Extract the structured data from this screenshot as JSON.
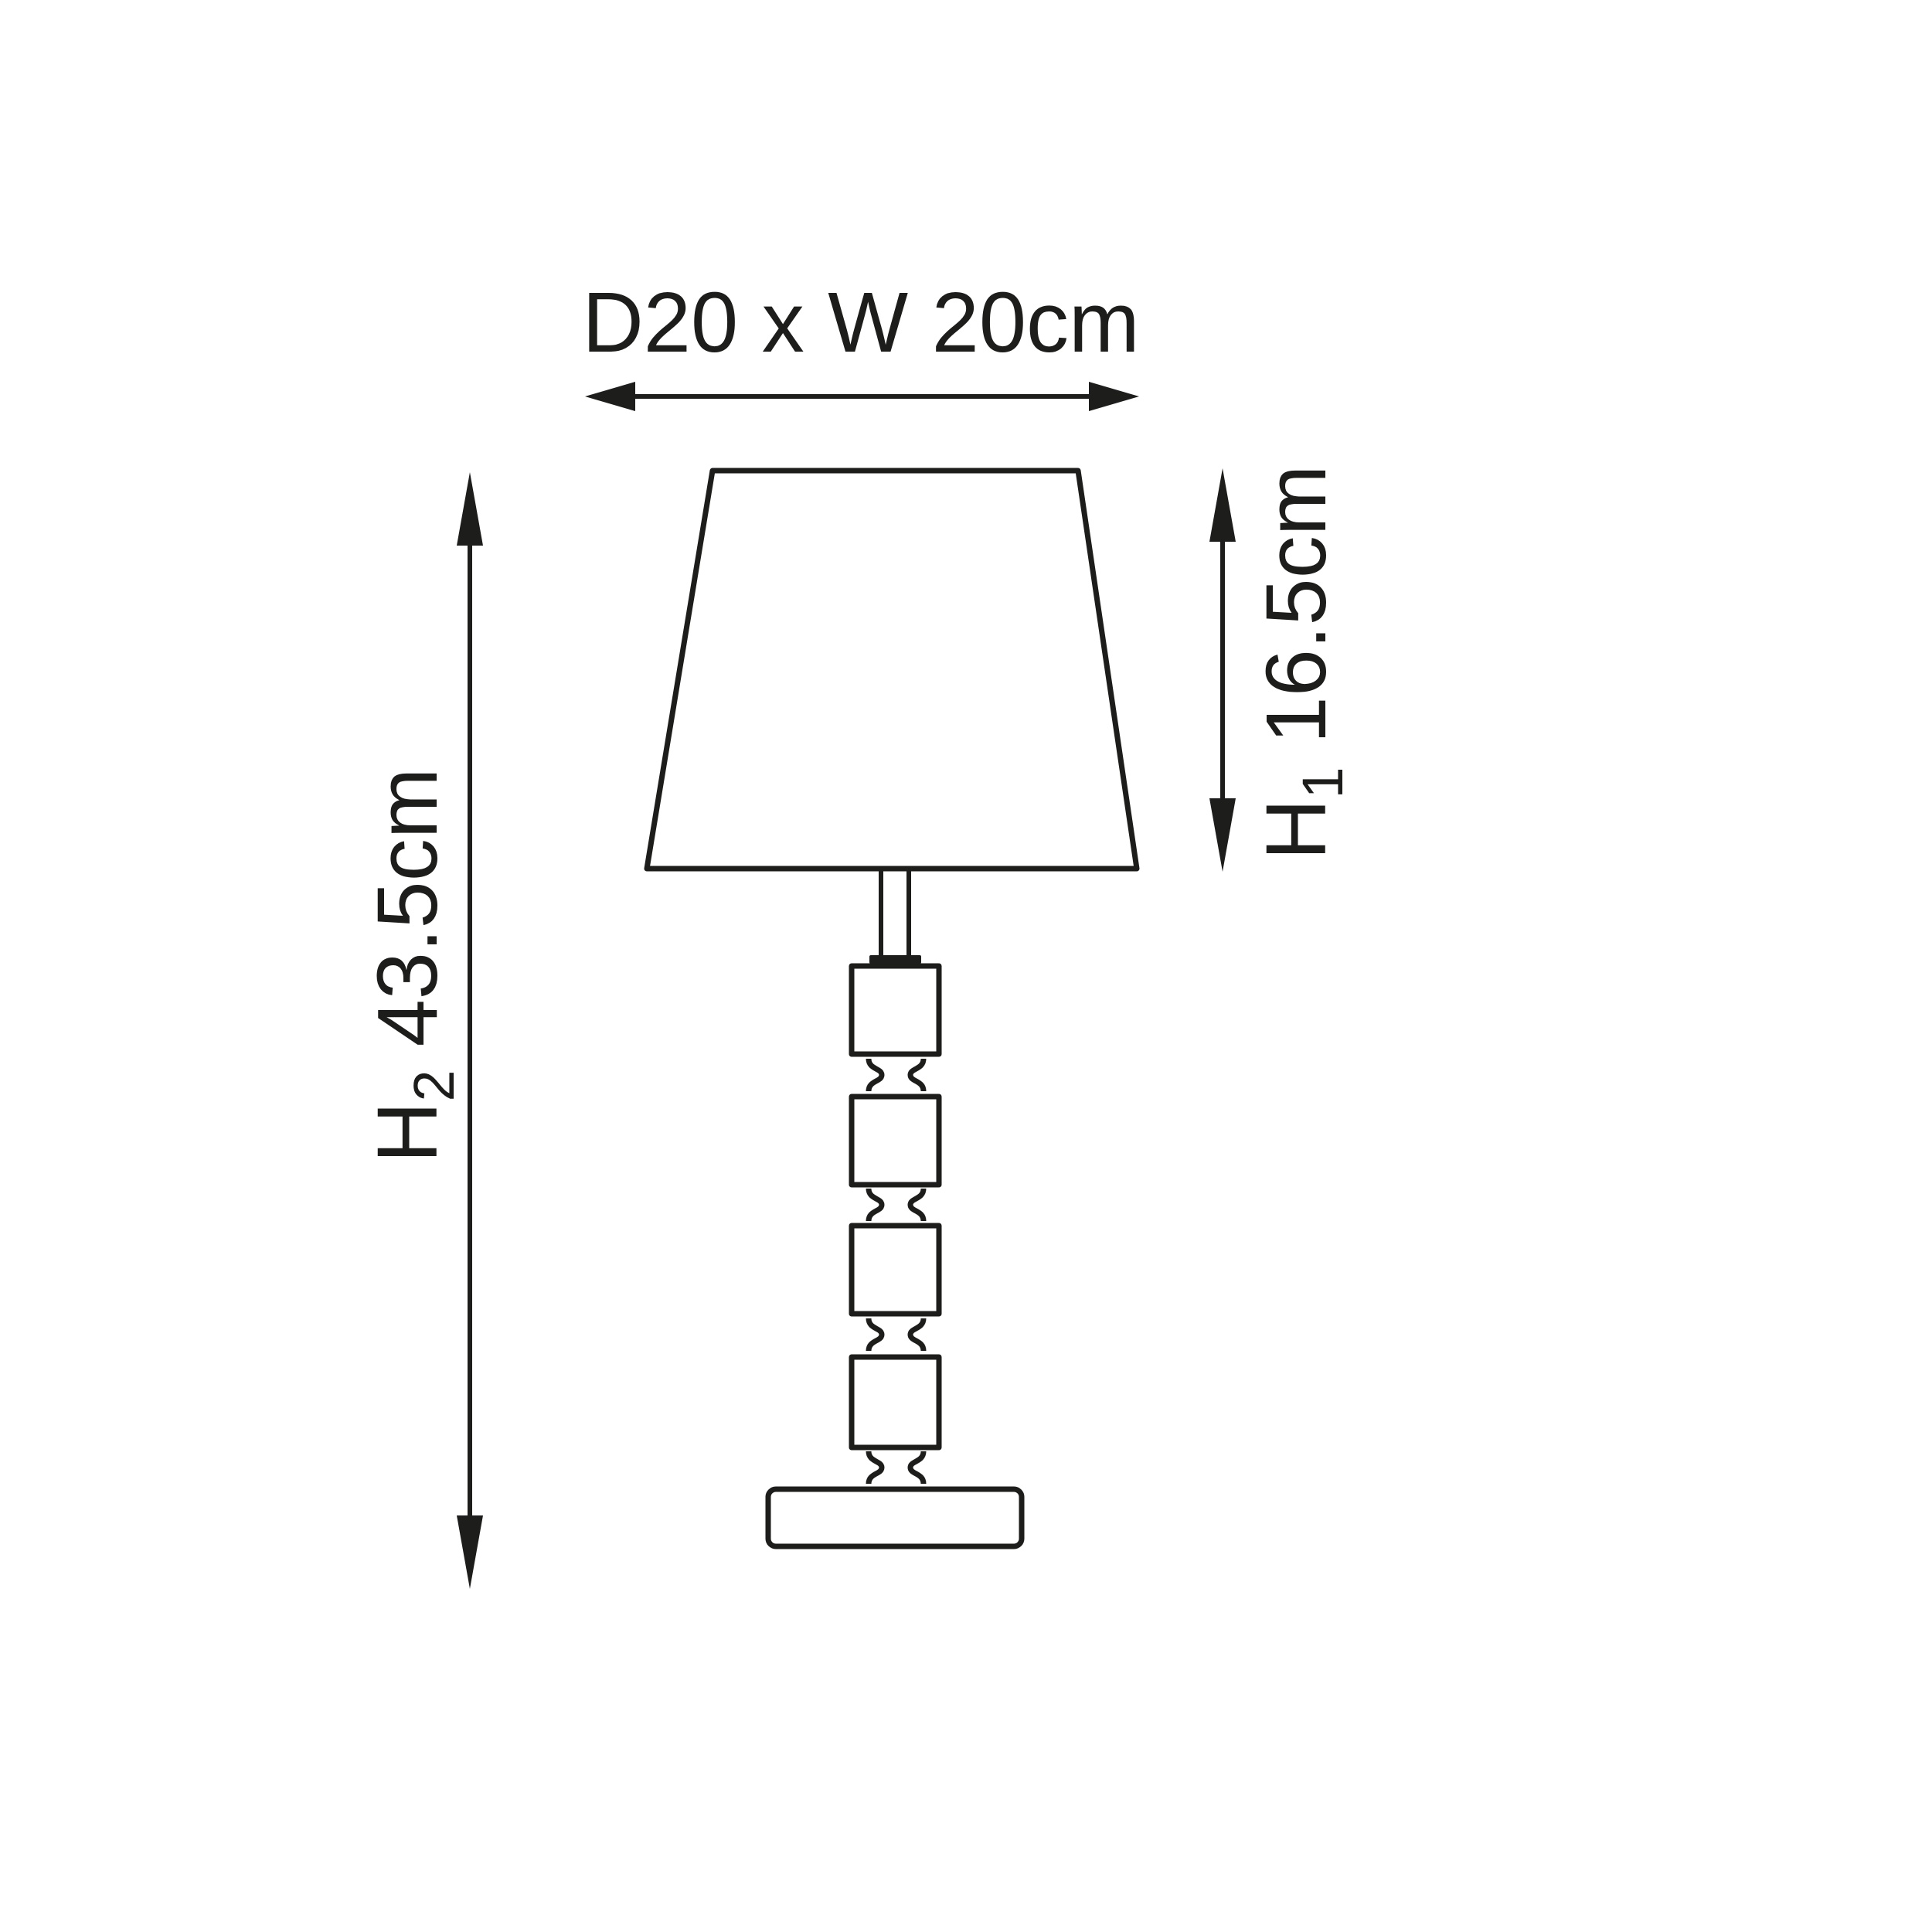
{
  "page": {
    "background_color": "#ffffff",
    "line_color": "#1d1d1b"
  },
  "dimensions": {
    "shade_width": {
      "label": "D20 x W 20cm",
      "orientation": "horizontal"
    },
    "total_height": {
      "symbol": "H",
      "subscript": "2",
      "value": "43.5cm",
      "orientation": "vertical"
    },
    "shade_height": {
      "symbol": "H",
      "subscript": "1",
      "value": "16.5cm",
      "orientation": "vertical"
    }
  }
}
